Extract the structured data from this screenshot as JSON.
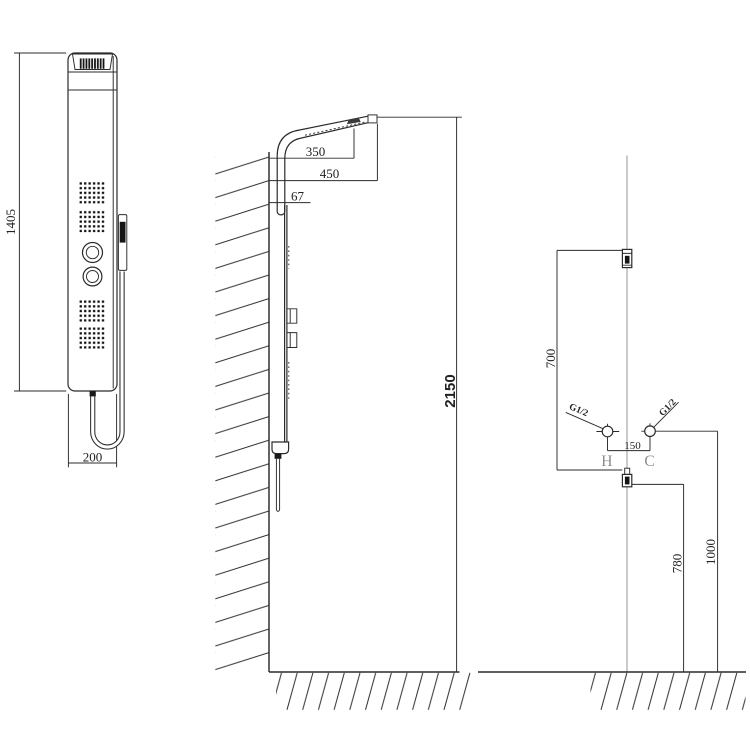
{
  "front_view": {
    "height_label": "1405",
    "width_label": "200"
  },
  "side_view": {
    "head_offset_label": "350",
    "head_reach_label": "450",
    "panel_depth_label": "67",
    "overall_height_label": "2150"
  },
  "installation_view": {
    "panel_span_label": "700",
    "inlet_spacing_label": "150",
    "hot_label": "H",
    "cold_label": "C",
    "hot_thread_label": "G1/2",
    "cold_thread_label": "G1/2",
    "lower_height_label": "780",
    "upper_height_label": "1000"
  },
  "colors": {
    "line": "#2b2b2b",
    "centerline": "#9a9a9a",
    "label_gray": "#8d8d8d",
    "background": "#ffffff"
  }
}
